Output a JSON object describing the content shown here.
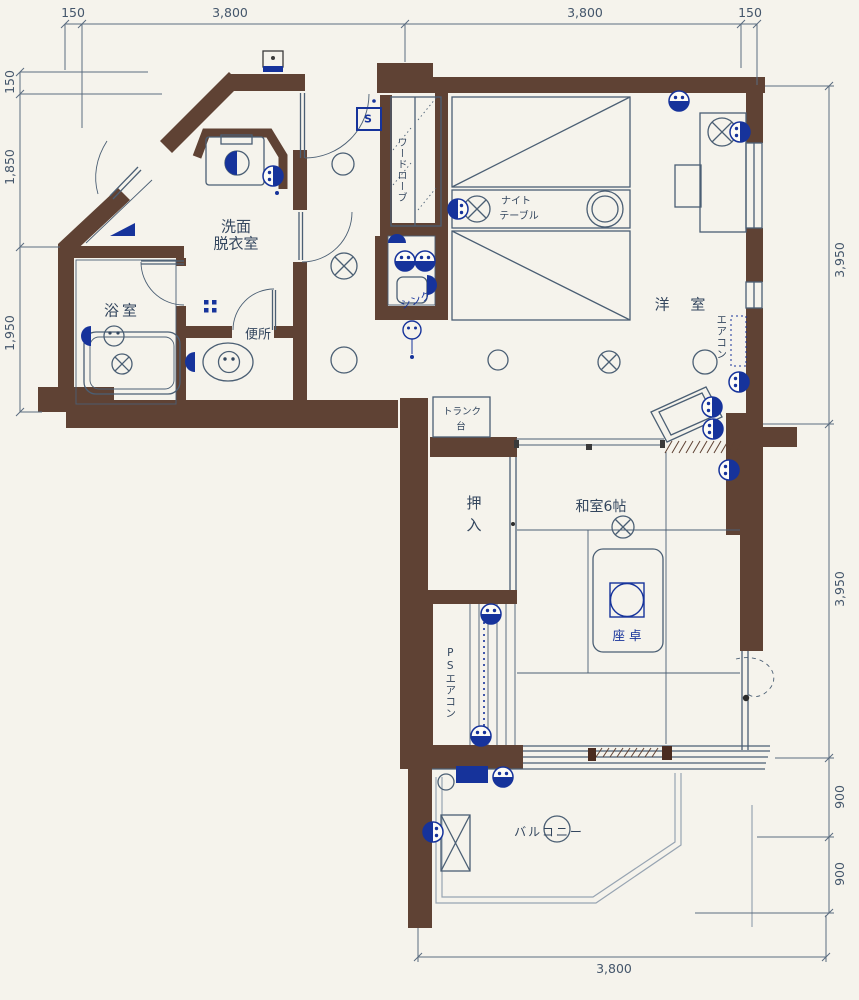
{
  "colors": {
    "wall": "#5f4234",
    "line": "#4b5f74",
    "electrical_navy": "#16339b",
    "background": "#f5f3ec",
    "text": "#33465e"
  },
  "dimensions": {
    "top": {
      "a": "150",
      "b": "3,800",
      "c": "3,800",
      "d": "150"
    },
    "left": {
      "a": "150",
      "b": "1,850",
      "c": "1,950"
    },
    "right": {
      "a": "3,950",
      "b": "3,950",
      "c": "900",
      "d": "900"
    },
    "bottom": {
      "a": "3,800"
    }
  },
  "rooms": {
    "washroom1": "洗面",
    "washroom2": "脱衣室",
    "bath": "浴室",
    "toilet": "便所",
    "western": "洋 室",
    "japanese": "和室6帖",
    "closet": "押入",
    "balcony": "バルコニー"
  },
  "fixtures": {
    "wardrobe": "ワードローブ",
    "sink": "シンク",
    "night1": "ナイト",
    "night2": "テーブル",
    "aircon": "エアコン",
    "trunk1": "トランク",
    "trunk2": "台",
    "low_table": "座卓",
    "ps_aircon": "PSエアコン",
    "switch": "S"
  }
}
